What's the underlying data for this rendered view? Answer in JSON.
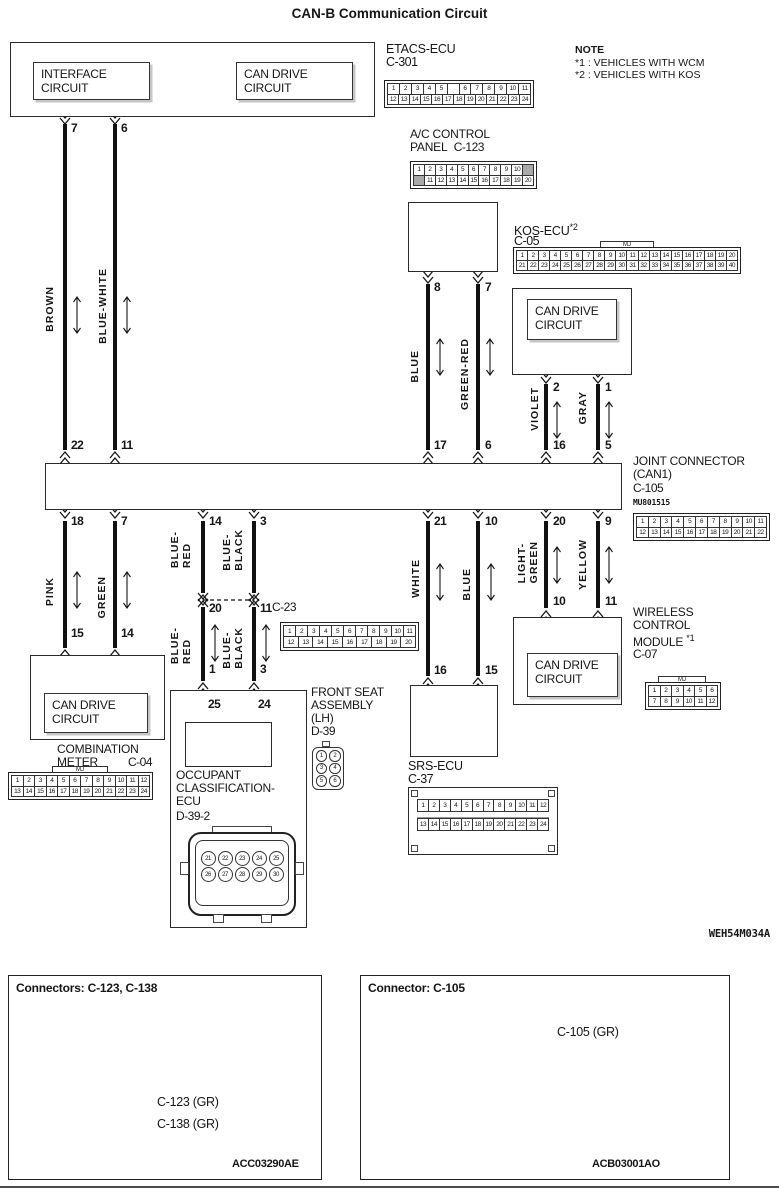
{
  "title": "CAN-B Communication Circuit",
  "note": {
    "heading": "NOTE",
    "line1": "*1 : VEHICLES WITH WCM",
    "line2": "*2 : VEHICLES WITH KOS"
  },
  "diagram_code": "WEH54M034A",
  "components": {
    "etacs": {
      "name": "ETACS-ECU",
      "connector": "C-301",
      "interface_box": "INTERFACE CIRCUIT",
      "can_drive_box": "CAN DRIVE CIRCUIT"
    },
    "ac_panel": {
      "name_line1": "A/C CONTROL",
      "name_line2": "PANEL",
      "connector": "C-123"
    },
    "kos": {
      "name": "KOS-ECU",
      "note_ref": "*2",
      "connector": "C-05",
      "can_drive_box": "CAN DRIVE CIRCUIT"
    },
    "joint": {
      "name_line1": "JOINT CONNECTOR",
      "name_line2": "(CAN1)",
      "connector": "C-105",
      "part_no": "MU801515"
    },
    "wcm": {
      "name_line1": "WIRELESS",
      "name_line2": "CONTROL",
      "name_line3": "MODULE",
      "note_ref": "*1",
      "connector": "C-07",
      "can_drive_box": "CAN DRIVE CIRCUIT"
    },
    "combination_meter": {
      "name_line1": "COMBINATION",
      "name_line2": "METER",
      "connector": "C-04",
      "can_drive_box": "CAN DRIVE CIRCUIT"
    },
    "front_seat": {
      "name_line1": "FRONT SEAT",
      "name_line2": "ASSEMBLY",
      "name_line3": "(LH)",
      "connector": "D-39"
    },
    "occupant_ecu": {
      "name_line1": "OCCUPANT",
      "name_line2": "CLASSIFICATION-",
      "name_line3": "ECU",
      "connector": "D-39-2"
    },
    "srs": {
      "name": "SRS-ECU",
      "connector": "C-37"
    },
    "c23": {
      "connector": "C-23"
    }
  },
  "wires": {
    "brown": {
      "label": [
        "BROWN"
      ],
      "pin_top": "7",
      "pin_bottom": "22"
    },
    "blue_white": {
      "label": [
        "BLUE-WHITE"
      ],
      "pin_top": "6",
      "pin_bottom": "11"
    },
    "ac_blue": {
      "label": [
        "BLUE"
      ],
      "pin_top": "8",
      "pin_bottom": "17"
    },
    "green_red": {
      "label": [
        "GREEN-RED"
      ],
      "pin_top": "7",
      "pin_bottom": "6"
    },
    "violet": {
      "label": [
        "VIOLET"
      ],
      "pin_top": "2",
      "pin_bottom": "16"
    },
    "gray": {
      "label": [
        "GRAY"
      ],
      "pin_top": "1",
      "pin_bottom": "5"
    },
    "pink": {
      "label": [
        "PINK"
      ],
      "pin_top": "18",
      "pin_bottom": "15"
    },
    "green": {
      "label": [
        "GREEN"
      ],
      "pin_top": "7",
      "pin_bottom": "14"
    },
    "blue_red_up": {
      "label": [
        "BLUE-",
        "RED"
      ],
      "pin_top": "14",
      "pin_bottom": "20"
    },
    "blue_black_up": {
      "label": [
        "BLUE-",
        "BLACK"
      ],
      "pin_top": "3",
      "pin_bottom": "11"
    },
    "blue_red_low": {
      "label": [
        "BLUE-",
        "RED"
      ],
      "pin_bottom": "1",
      "pin_seat": "25"
    },
    "blue_black_low": {
      "label": [
        "BLUE-",
        "BLACK"
      ],
      "pin_bottom": "3",
      "pin_seat": "24"
    },
    "white": {
      "label": [
        "WHITE"
      ],
      "pin_top": "21",
      "pin_bottom": "16"
    },
    "srs_blue": {
      "label": [
        "BLUE"
      ],
      "pin_top": "10",
      "pin_bottom": "15"
    },
    "light_green": {
      "label": [
        "LIGHT-",
        "GREEN"
      ],
      "pin_top": "20",
      "pin_bottom": "10"
    },
    "yellow": {
      "label": [
        "YELLOW"
      ],
      "pin_top": "9",
      "pin_bottom": "11"
    }
  },
  "connector_pinouts": {
    "c301": {
      "rows": [
        [
          "1",
          "2",
          "3",
          "4",
          "5",
          "",
          "6",
          "7",
          "8",
          "9",
          "10",
          "11"
        ],
        [
          "12",
          "13",
          "14",
          "15",
          "16",
          "17",
          "18",
          "19",
          "20",
          "21",
          "22",
          "23",
          "24"
        ]
      ]
    },
    "c123": {
      "rows": [
        [
          "1",
          "2",
          "3",
          "4",
          "5",
          "6",
          "7",
          "8",
          "9",
          "10",
          "#"
        ],
        [
          "#",
          "11",
          "12",
          "13",
          "14",
          "15",
          "16",
          "17",
          "18",
          "19",
          "20"
        ]
      ]
    },
    "c05": {
      "tab": "MJ",
      "rows": [
        [
          "1",
          "2",
          "3",
          "4",
          "5",
          "6",
          "7",
          "8",
          "9",
          "10",
          "11",
          "12",
          "13",
          "14",
          "15",
          "16",
          "17",
          "18",
          "19",
          "20"
        ],
        [
          "21",
          "22",
          "23",
          "24",
          "25",
          "26",
          "27",
          "28",
          "29",
          "30",
          "31",
          "32",
          "33",
          "34",
          "35",
          "36",
          "37",
          "38",
          "39",
          "40"
        ]
      ]
    },
    "c105": {
      "rows": [
        [
          "1",
          "2",
          "3",
          "4",
          "5",
          "6",
          "7",
          "8",
          "9",
          "10",
          "11"
        ],
        [
          "12",
          "13",
          "14",
          "15",
          "16",
          "17",
          "18",
          "19",
          "20",
          "21",
          "22"
        ]
      ]
    },
    "c04": {
      "tab": "MJ",
      "rows": [
        [
          "1",
          "2",
          "3",
          "4",
          "5",
          "6",
          "7",
          "8",
          "9",
          "10",
          "11",
          "12"
        ],
        [
          "13",
          "14",
          "15",
          "16",
          "17",
          "18",
          "19",
          "20",
          "21",
          "22",
          "23",
          "24"
        ]
      ]
    },
    "c07": {
      "tab": "MJ",
      "rows": [
        [
          "1",
          "2",
          "3",
          "4",
          "5",
          "6"
        ],
        [
          "7",
          "8",
          "9",
          "10",
          "11",
          "12"
        ]
      ]
    },
    "c37": {
      "rows": [
        [
          "1",
          "2",
          "3",
          "4",
          "5",
          "6",
          "7",
          "8",
          "9",
          "10",
          "11",
          "12"
        ],
        [
          "13",
          "14",
          "15",
          "16",
          "17",
          "18",
          "19",
          "20",
          "21",
          "22",
          "23",
          "24"
        ]
      ]
    },
    "c23": {
      "rows": [
        [
          "1",
          "2",
          "3",
          "4",
          "5",
          "6",
          "7",
          "8",
          "9",
          "10",
          "11"
        ],
        [
          "12",
          "13",
          "14",
          "15",
          "16",
          "17",
          "18",
          "19",
          "20"
        ]
      ]
    },
    "d39": {
      "rows": [
        [
          "1",
          "2"
        ],
        [
          "3",
          "4"
        ],
        [
          "5",
          "6"
        ]
      ]
    },
    "d39_2": {
      "rows": [
        [
          "21",
          "22",
          "23",
          "24",
          "25"
        ],
        [
          "26",
          "27",
          "28",
          "29",
          "30"
        ]
      ]
    }
  },
  "photos": {
    "left": {
      "title": "Connectors: C-123, C-138",
      "label1": "C-123 (GR)",
      "label2": "C-138 (GR)",
      "code": "ACC03290AE"
    },
    "right": {
      "title": "Connector: C-105",
      "label": "C-105 (GR)",
      "code": "ACB03001AO"
    }
  }
}
